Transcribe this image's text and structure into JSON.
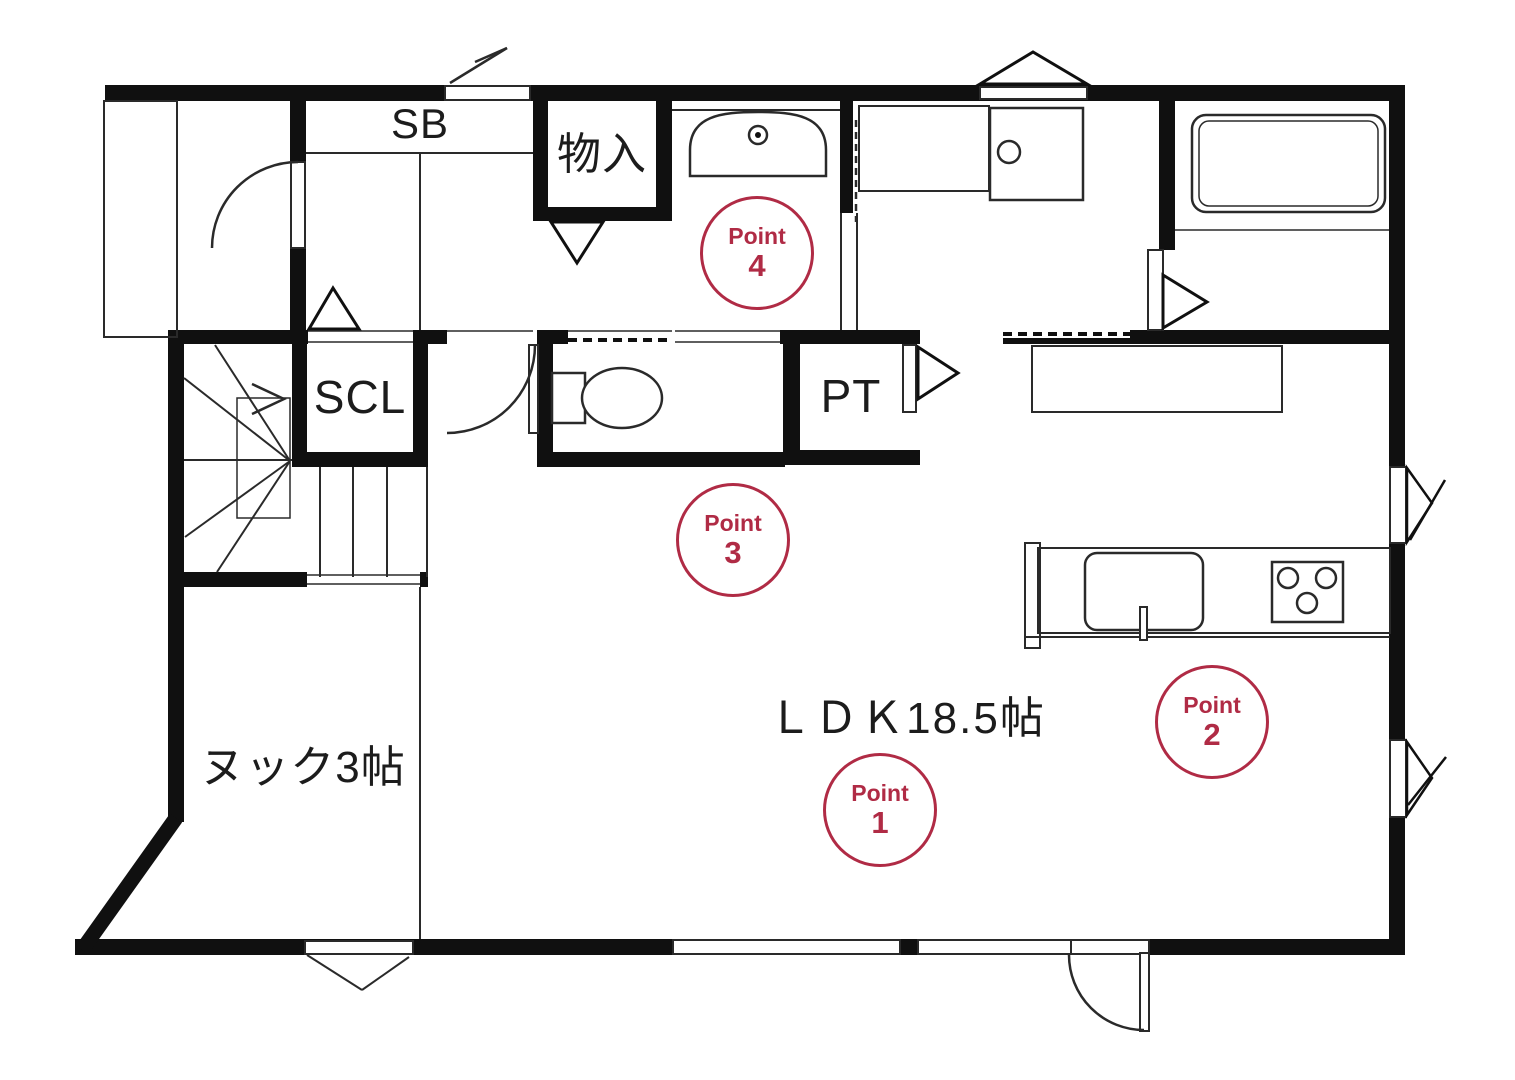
{
  "plan_title": "1F floor plan",
  "rooms": {
    "shoe_box_label": "SB",
    "storage_label": "物入",
    "shoe_closet_label": "SCL",
    "pantry_label": "PT",
    "ldk_label": "ＬＤＫ18.5帖",
    "nook_label": "ヌック3帖"
  },
  "points": [
    {
      "label": "Point",
      "number": "1"
    },
    {
      "label": "Point",
      "number": "2"
    },
    {
      "label": "Point",
      "number": "3"
    },
    {
      "label": "Point",
      "number": "4"
    }
  ],
  "colors": {
    "point_accent": "#b02b45",
    "wall": "#101010",
    "line": "#2a2a2a"
  }
}
